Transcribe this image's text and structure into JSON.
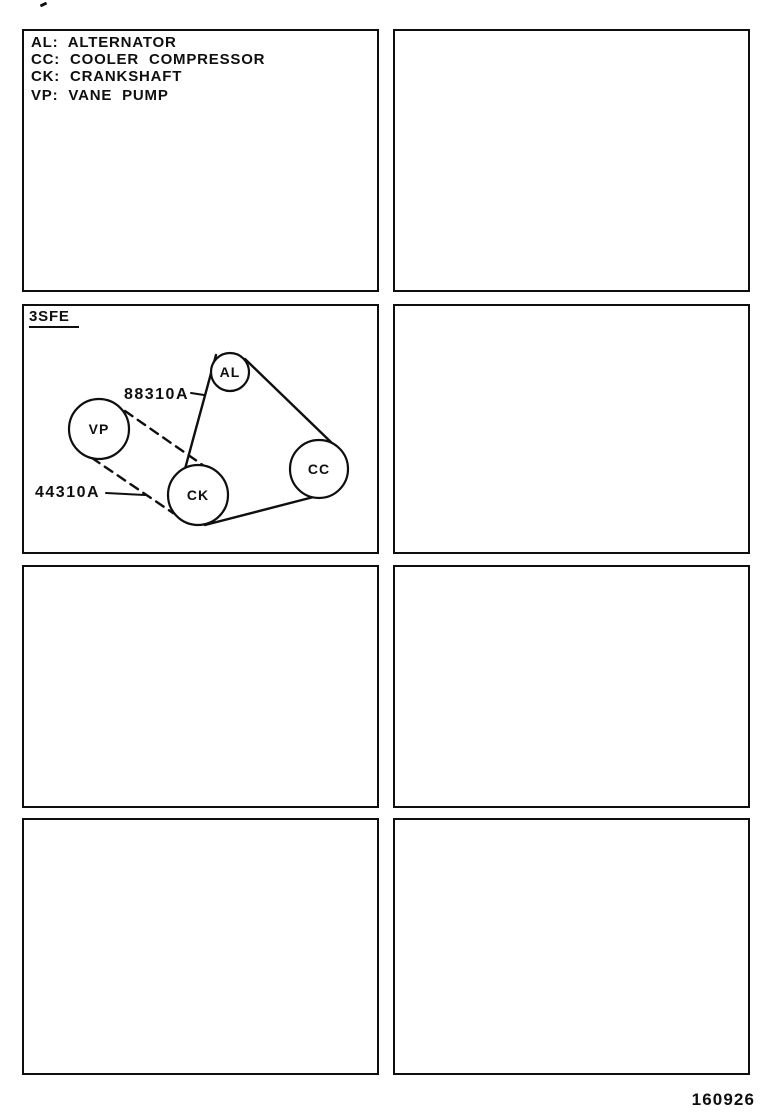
{
  "page": {
    "footer_code": "160926"
  },
  "legend": {
    "items": [
      {
        "abbr": "AL",
        "name": "ALTERNATOR",
        "text": "AL: ALTERNATOR"
      },
      {
        "abbr": "CC",
        "name": "COOLER COMPRESSOR",
        "text": "CC: COOLER COMPRESSOR"
      },
      {
        "abbr": "CK",
        "name": "CRANKSHAFT",
        "text": "CK: CRANKSHAFT"
      },
      {
        "abbr": "VP",
        "name": "VANE PUMP",
        "text": "VP: VANE PUMP"
      }
    ]
  },
  "diagram": {
    "engine_code": "3SFE",
    "pulleys": [
      {
        "id": "AL",
        "label": "AL"
      },
      {
        "id": "VP",
        "label": "VP"
      },
      {
        "id": "CK",
        "label": "CK"
      },
      {
        "id": "CC",
        "label": "CC"
      }
    ],
    "part_numbers": [
      {
        "number": "88310A"
      },
      {
        "number": "44310A"
      }
    ]
  }
}
